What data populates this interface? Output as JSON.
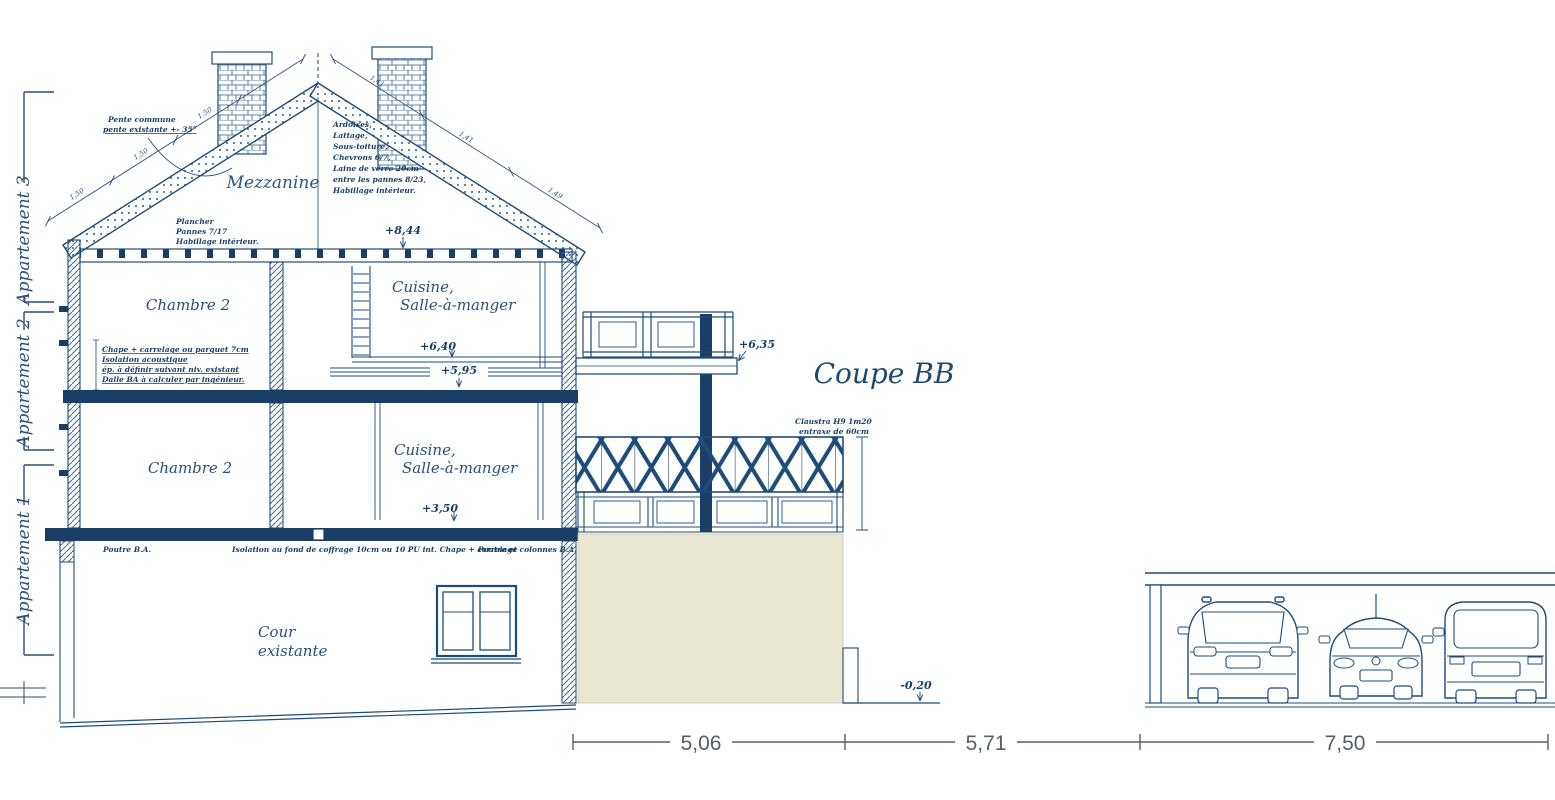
{
  "title": "Coupe BB",
  "apartments": {
    "a3": "Appartement 3",
    "a2": "Appartement 2",
    "a1": "Appartement 1"
  },
  "rooms": {
    "mezzanine": "Mezzanine",
    "chambre_upper": "Chambre 2",
    "chambre_lower": "Chambre 2",
    "cuisine_l1": "Cuisine,",
    "cuisine_l2": "Salle-à-manger",
    "cour_l1": "Cour",
    "cour_l2": "existante"
  },
  "elevations": {
    "attic": "+8,44",
    "kitchen": "+6,40",
    "floor2": "+5,95",
    "floor1": "+3,50",
    "balcony": "+6,35",
    "ground": "-0,20"
  },
  "notes": {
    "pente": [
      "Pente commune",
      "pente existante +- 35°"
    ],
    "roof": [
      "Ardoises,",
      "Lattage,",
      "Sous-toiture,",
      "Chevrons 6/7,",
      "Laine de verre 20cm",
      "entre les pannes 8/23,",
      "Habillage intérieur."
    ],
    "plancher": [
      "Plancher",
      "Pannes 7/17",
      "Habillage intérieur."
    ],
    "chape": [
      "Chape + carrelage ou parquet 7cm",
      "Isolation acoustique",
      "ép. à définir suivant niv. existant",
      "Dalle BA à calculer par ingénieur."
    ],
    "beam_left": "Poutre B.A.",
    "beam_mid": "Isolation au fond de coffrage 10cm ou 10 PU int. Chape + carrelage",
    "beam_right": "Poutre et colonnes B.A.",
    "claustra": [
      "Claustra H9 1m20",
      "entraxe de 60cm"
    ]
  },
  "dimensions": {
    "bottom": [
      "5,06",
      "5,71",
      "7,50"
    ],
    "roof_left": [
      "1,50",
      "1,50",
      "1,50"
    ],
    "roof_right": [
      "1,41",
      "1,41",
      "1,49"
    ]
  },
  "colors": {
    "line": "#1e4c78",
    "dark_fill": "#1a3f66",
    "beige": "#e9e7d2",
    "dim_text": "#545f68"
  }
}
